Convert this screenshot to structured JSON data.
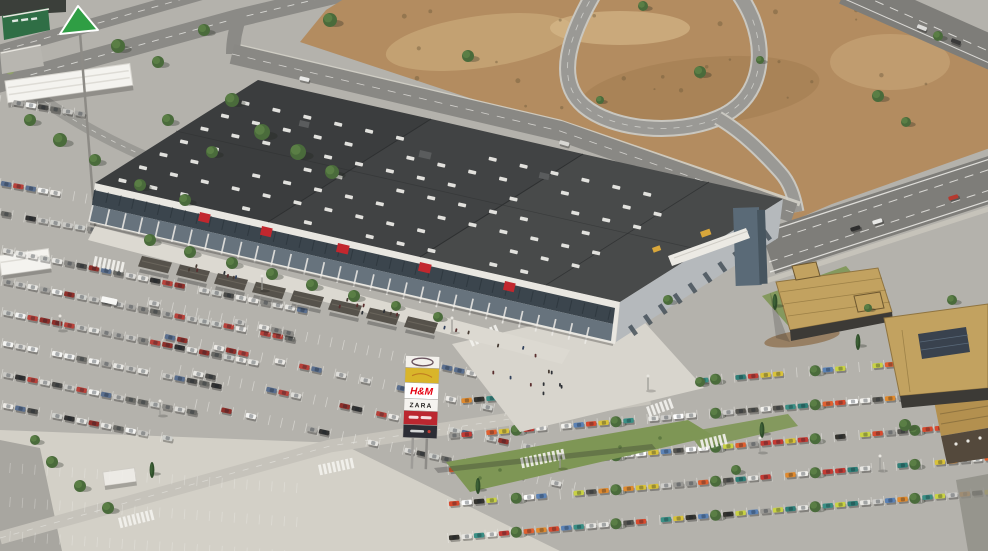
{
  "scene": {
    "name": "retail-park-aerial-render",
    "description": "Aerial 3D architectural rendering of a retail park: large dark-roofed shopping centre with glazed storefront facade, brand pylon sign, restaurant pad buildings, dense car parks, and a motorway interchange loop over bare terrain."
  },
  "colors": {
    "asphalt": "#b4b2ac",
    "concrete": "#d3d0c7",
    "dirt": "#b38c60",
    "dirt_light": "#cdac7d",
    "dirt_dark": "#977348",
    "road": "#8b8a86",
    "road_light": "#9b9a95",
    "highway": "#7e7d79",
    "lane": "#f2f1ed",
    "roof_left": "#3b3d3e",
    "roof_mid": "#414344",
    "roof_right": "#484a4a",
    "roof_seam": "#2e3031",
    "skylight": "#f0efea",
    "facade": "#e9e7e1",
    "glass_band": "#323c44",
    "storefront": "#67737d",
    "walkway": "#dcd9d1",
    "pergola": "#56524b",
    "banner_red": "#c2272e",
    "right_facade": "#b5b9bc",
    "tower": "#5a6a77",
    "tower_side": "#47555f",
    "canopy": "#eceae4",
    "yellow": "#d9a73b",
    "tan_roof": "#c2a260",
    "tan_dark": "#8f7440",
    "wall_dark": "#3c3a36",
    "solar": "#39424e",
    "grass": "#7e9655",
    "grass_dark": "#5f7a41",
    "tree": "#4a6b3b",
    "tree_light": "#5d8148",
    "green_store": "#2f6e45",
    "leroy_green": "#2f9e44",
    "pole": "#9e9c98",
    "white": "#f4f3ef",
    "wood": "#b3904f",
    "terrace": "#54493c"
  },
  "pylon": {
    "panels": [
      {
        "id": "top-logo",
        "bg": "#f3f1ec",
        "label": ""
      },
      {
        "id": "brand-yellow",
        "bg": "#d9b52a",
        "label": ""
      },
      {
        "id": "brand-hm",
        "bg": "#ffffff",
        "label": "H&M",
        "color": "#e50010"
      },
      {
        "id": "brand-zara",
        "bg": "#f6f4f0",
        "label": "ZARA",
        "color": "#23211f"
      },
      {
        "id": "brand-red",
        "bg": "#bb2730",
        "label": ""
      },
      {
        "id": "brand-dark",
        "bg": "#2c2d35",
        "label": ""
      }
    ]
  },
  "parking": {
    "palettes": {
      "muted": [
        "#f4f4f2",
        "#eceae6",
        "#dddcd8",
        "#c9c8c4",
        "#a9a8a4",
        "#8b8a86",
        "#6a6a66",
        "#4a4a48",
        "#333333",
        "#b8413a",
        "#8f2f2a",
        "#5a6f8f",
        "#cfd0cc",
        "#e8e7e3"
      ],
      "colorful": [
        "#e06030",
        "#d84a2e",
        "#c43a33",
        "#3a8f85",
        "#2f7f78",
        "#c9d245",
        "#d9c23a",
        "#f2f1ed",
        "#ffffff",
        "#cfcecb",
        "#9a9995",
        "#55544f",
        "#35342f",
        "#5b82b5",
        "#e08a2e",
        "#e8e7e3"
      ]
    },
    "lots": [
      {
        "name": "west-lot",
        "x": 2,
        "y": 250,
        "rows": 6,
        "dy": 31,
        "slope": 0.2,
        "len": 318,
        "palette": "muted",
        "fill": 0.93,
        "shrink": 30
      },
      {
        "name": "front-lot",
        "x": 148,
        "y": 302,
        "rows": 4,
        "dy": 34,
        "slope": 0.22,
        "len": 370,
        "palette": "muted",
        "fill": 0.5,
        "shrink": -8,
        "xstep": 16
      },
      {
        "name": "east-lot",
        "x": 448,
        "y": 402,
        "rows": 5,
        "dy": 34,
        "slope": -0.085,
        "len": 540,
        "palette": "colorful",
        "fill": 0.88,
        "shrink": -18,
        "treeEvery": 8
      },
      {
        "name": "northwest-lot",
        "x": 0,
        "y": 183,
        "rows": 2,
        "dy": 30,
        "slope": 0.18,
        "len": 100,
        "palette": "muted",
        "fill": 0.55
      },
      {
        "name": "canopy-row",
        "x": 0,
        "y": 100,
        "rows": 1,
        "dy": 0,
        "slope": 0.17,
        "len": 80,
        "palette": "muted",
        "fill": 0.85
      }
    ],
    "empty_rows": [
      {
        "x": 10,
        "y": 468,
        "rows": 3,
        "dy": 34,
        "slope": 0.07,
        "len": 300
      }
    ]
  },
  "trees": [
    [
      330,
      20,
      7
    ],
    [
      468,
      56,
      6
    ],
    [
      700,
      72,
      6
    ],
    [
      643,
      6,
      5
    ],
    [
      878,
      96,
      6
    ],
    [
      906,
      122,
      5
    ],
    [
      938,
      36,
      5
    ],
    [
      600,
      100,
      4
    ],
    [
      760,
      60,
      4
    ],
    [
      118,
      46,
      7
    ],
    [
      158,
      62,
      6
    ],
    [
      204,
      30,
      6
    ],
    [
      232,
      100,
      7
    ],
    [
      262,
      132,
      8
    ],
    [
      298,
      152,
      8
    ],
    [
      332,
      172,
      7
    ],
    [
      212,
      152,
      6
    ],
    [
      168,
      120,
      6
    ],
    [
      30,
      120,
      6
    ],
    [
      60,
      140,
      7
    ],
    [
      95,
      160,
      6
    ],
    [
      140,
      185,
      6
    ],
    [
      185,
      200,
      6
    ],
    [
      150,
      240,
      6
    ],
    [
      190,
      252,
      6
    ],
    [
      232,
      263,
      6
    ],
    [
      272,
      274,
      6
    ],
    [
      312,
      285,
      6
    ],
    [
      354,
      296,
      6
    ],
    [
      396,
      306,
      5
    ],
    [
      438,
      317,
      5
    ],
    [
      668,
      300,
      5
    ],
    [
      700,
      382,
      5
    ],
    [
      736,
      470,
      5
    ],
    [
      905,
      425,
      6
    ],
    [
      952,
      300,
      5
    ],
    [
      868,
      308,
      4
    ],
    [
      52,
      462,
      6
    ],
    [
      80,
      486,
      6
    ],
    [
      108,
      508,
      6
    ],
    [
      35,
      440,
      5
    ]
  ],
  "cypresses": [
    [
      478,
      486
    ],
    [
      762,
      430
    ],
    [
      775,
      302
    ],
    [
      858,
      342
    ],
    [
      152,
      470
    ]
  ],
  "people_colors": [
    "#2e3136",
    "#473c34",
    "#31415c",
    "#5a2f2f"
  ],
  "streetlights": [
    [
      262,
      290
    ],
    [
      452,
      332
    ],
    [
      648,
      390
    ],
    [
      160,
      415
    ],
    [
      560,
      468
    ],
    [
      760,
      452
    ],
    [
      60,
      330
    ],
    [
      880,
      470
    ]
  ],
  "crosswalks": [
    [
      95,
      256,
      12,
      7
    ],
    [
      468,
      337,
      -24,
      7
    ],
    [
      318,
      465,
      -12,
      8
    ],
    [
      520,
      458,
      -12,
      10
    ],
    [
      700,
      440,
      -14,
      6
    ],
    [
      118,
      518,
      -14,
      8
    ],
    [
      646,
      407,
      -20,
      6
    ]
  ],
  "highway_cars": [
    [
      850,
      228,
      -17,
      "#2e2e2e",
      10,
      4
    ],
    [
      872,
      221,
      -17,
      "#e8e8e6",
      10,
      4
    ],
    [
      948,
      197,
      -17,
      "#b53a30",
      10,
      4
    ],
    [
      918,
      24,
      21,
      "#dcdcda",
      10,
      4
    ],
    [
      952,
      38,
      21,
      "#3a3a3a",
      10,
      4
    ],
    [
      300,
      76,
      13,
      "#e9e9e7",
      10,
      4
    ],
    [
      560,
      140,
      16,
      "#d8d8d4",
      10,
      4
    ],
    [
      102,
      296,
      12,
      "#f7f7f5",
      16,
      6
    ]
  ]
}
